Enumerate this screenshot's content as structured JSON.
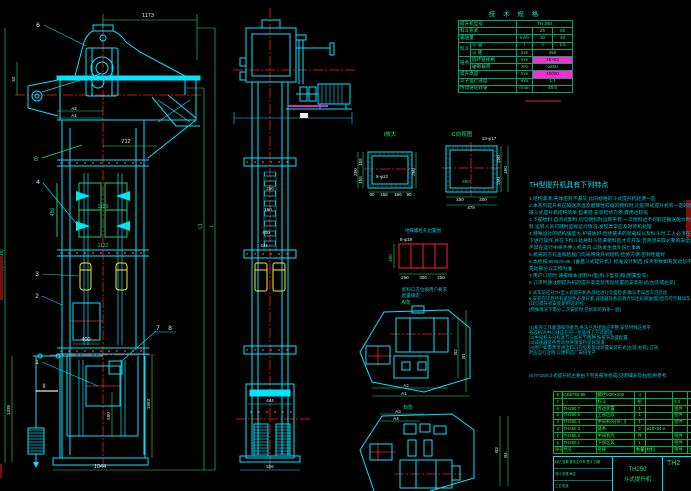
{
  "colors": {
    "background": "#000000",
    "line_cyan": "#00e5ff",
    "dim_white": "#e8e8e8",
    "green": "#19e57f",
    "red_centerline": "#ff2020",
    "bucket_yellow": "#ffe926",
    "magenta": "#ff2bd1",
    "dark_red": "#7a0f0f",
    "table_green": "#2de396",
    "bom_green": "#2bff52"
  },
  "front_view": {
    "part_labels": {
      "p6": "6",
      "p4": "4",
      "p3": "3",
      "p2": "2",
      "p1": "1",
      "p7": "7",
      "p8": "8",
      "section": "II",
      "b": "B",
      "a2": "A2",
      "a1": "A1"
    },
    "dims": {
      "top": "1173",
      "spout": "712",
      "door": "450",
      "pitch": "1130",
      "band": "1132",
      "window": "400",
      "left_h": "1335",
      "right_h": "1553",
      "inner_h": "550",
      "base": "1044",
      "total": "H(总高4946)",
      "top_left": "52",
      "l1": "L1",
      "l": "L"
    }
  },
  "side_view": {
    "dims": {
      "c1": "250",
      "c2": "160",
      "c3": "400",
      "c4": "444",
      "boot_top": "444",
      "boot_base": "556"
    }
  },
  "detail_i": {
    "title": "I放大",
    "hole": "8-φ12",
    "left": [
      "350",
      "155",
      "155"
    ],
    "right": "360",
    "bottom": [
      "90",
      "156",
      "156",
      "90"
    ]
  },
  "detail_c": {
    "title": "C向视图",
    "hole": "13-φ17",
    "inner": "600",
    "right": [
      "250",
      "250",
      "450"
    ],
    "bottom": [
      "250",
      "200",
      "479"
    ]
  },
  "anchor_plan": {
    "title": "地脚螺栓孔位置图",
    "hole": "8-φ18",
    "height": "450",
    "bottom": [
      "250",
      "300",
      "250"
    ],
    "note1": "卸料口方位按用户要求",
    "note2": "配置确定"
  },
  "top_view_a": {
    "title": "A向",
    "a2": "A2",
    "a1": "A1",
    "b2": "B2",
    "b1": "B1"
  },
  "top_view_b": {
    "title": "B向",
    "a3": "A3",
    "a4": "A4",
    "b3": "B3",
    "b4": "B4"
  },
  "spec_table": {
    "title": "技 术 规 格",
    "rows": [
      {
        "label": "提升机型号",
        "value": "TH 250",
        "span": 3
      },
      {
        "label": "料斗形式",
        "v1": "Zh",
        "v2": "Sh"
      },
      {
        "label": "输送量",
        "unit": "m³/h",
        "v1": "30",
        "v2": "48"
      },
      {
        "group": "料斗",
        "gspan": 2,
        "label": "斗 容",
        "unit": "l",
        "v1": "3",
        "v2": "1.6"
      },
      {
        "label": "斗 距",
        "unit": "mm",
        "value": "450",
        "span": 2
      },
      {
        "group": "链条",
        "gspan": 2,
        "label": "圆环链规格",
        "unit": "mm",
        "value": "18×64",
        "span": 2,
        "hl": true
      },
      {
        "label": "破断载荷",
        "unit": "KN",
        "value": "≥250",
        "span": 2
      },
      {
        "label": "提升高度",
        "unit": "mm",
        "value": "40000",
        "span": 2,
        "hl": true
      },
      {
        "label": "斗子运行速度",
        "unit": "m/s",
        "value": "1.1",
        "span": 2
      },
      {
        "label": "传动链轮转速",
        "unit": "r/min",
        "value": "48.5",
        "span": 2
      }
    ]
  },
  "features": {
    "title": "TH型提升机具有下列特点",
    "lines": [
      "1.结构紧凑,壳体密封不漏灰,比同规格的斗式提升机轻便一些",
      "2.本系列提升机在输送高温及磨琢性较强的物料时,比胶带式提升机有一定的优越性,并且比",
      "  链斗式提升机结构简单,自重轻,安装检修方便,费用也较低",
      "3.下部给料,自流式卸料,均匀喂料时运转平稳;一次给料达不到额定输送能力时,可分次给",
      "  料,运转人员可随时监视运行情况,发现异常应及时停机处理",
      "4.特殊设计的结构强度大,护链板好;检修链条的装载段以及料斗时,工人必须在停机的状态",
      "  下进行操作,并在下料斗处将料斗装满物料后才可开车;否则须采取必要的安全防护措施,",
      "  严禁在运行中将手伸入机壳内,以防发生意外伤亡事故",
      "5.机壳的方孔盖和检视门均采用快开式结构,检修方便,密封性能好",
      "6.本机按JB3926-85《垂直斗式提升机》标准设计制造,技术参数如有变动恕不另行通知",
      "  变动部分以实物为准",
      "7.用户订货时,请按样本注明TH型(料斗型号)和(配置型号)",
      "8.订货时请注明提升机的提升高度及传动装置的安装形式(左装或右装)"
    ],
    "notes": [
      "5.试车前应对TH型斗式提升机各部位进行全面检查,确认无误后方可启动",
      "6.安装完毕后所有紧固件必须拧紧,减速器及各润滑点加注润滑油(脂)后方可空载试车,空载试车不少于2小时",
      "(详见提升机安装使用说明书)",
      "(特殊情况下需分二次安装时,已拆卸的链条一副)"
    ],
    "notes2": [
      "(1)机壳工作面须保持垂直,各法兰连接面应平整,安装时找正找平,",
      "   各段机壳中心线应在同一铅垂线上方可紧固",
      "(2)中间机壳分标准节与加长节两种,按提升高度配置",
      "(3)减速器及各传动部件须保持良好润滑",
      "(4)用户如需改变进出料口方位及驱动装置安装形式(左装,右装),订货,",
      "   时应自行注明,以便制造厂安排生产"
    ],
    "final": "(5)TH250斗式提升机主要由下列各部件组成(见明细表及右图)供参考."
  },
  "bom": {
    "headers": [
      "序号",
      "代号",
      "名称",
      "数量",
      "材料",
      "单件",
      "总计"
    ],
    "rows": [
      [
        "8",
        "GB5782-86",
        "螺栓M20×200",
        "4",
        "",
        "",
        ""
      ],
      [
        "7",
        "",
        "料斗",
        "组",
        "",
        "9.0",
        ""
      ],
      [
        "6",
        "TH250.7",
        "传动装置",
        "1",
        "",
        "组件",
        ""
      ],
      [
        "5",
        "TH250.6",
        "上部区段",
        "1",
        "",
        "组件",
        ""
      ],
      [
        "4",
        "TH250.4",
        "中间机壳(带门)",
        "1",
        "",
        "组件",
        ""
      ],
      [
        "3",
        "TH250.3",
        "链条",
        "2",
        "φ18×64-A",
        "",
        ""
      ],
      [
        "2",
        "TH250.2",
        "中间机壳",
        "件",
        "",
        "组件",
        ""
      ],
      [
        "1",
        "TH250.1",
        "下部区段",
        "1",
        "",
        "组件",
        ""
      ]
    ]
  },
  "title_block": {
    "model": "TH250",
    "product": "斗式提升机",
    "drawing_no": "TH2",
    "row1": "标记 处数 更改文件号 签字 日期",
    "row2": "设计    校核    审定",
    "row3": "工艺    批准"
  }
}
